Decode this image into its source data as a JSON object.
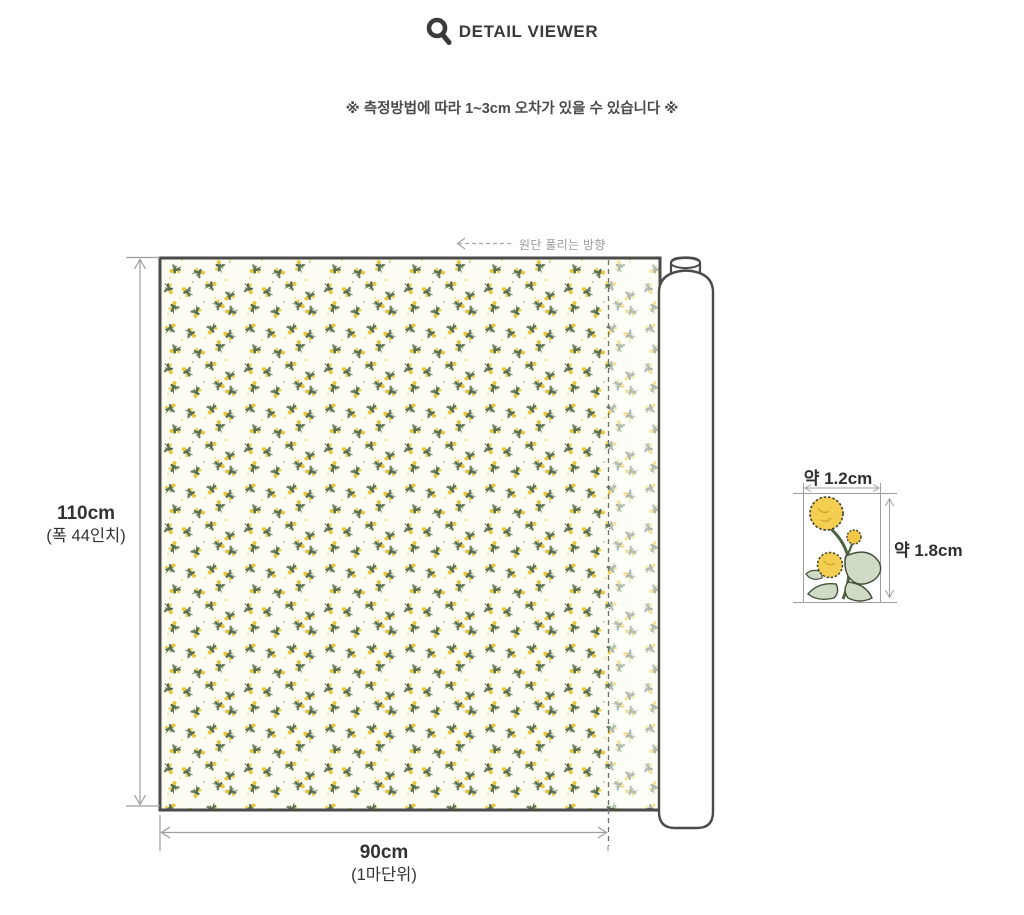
{
  "header": {
    "title": "DETAIL VIEWER"
  },
  "notice": "※ 측정방법에 따라 1~3cm 오차가 있을 수 있습니다 ※",
  "fabric_diagram": {
    "unroll_direction": "원단 풀리는 방향",
    "height": {
      "value": "110cm",
      "note": "(폭 44인치)"
    },
    "width": {
      "value": "90cm",
      "note": "(1마단위)"
    }
  },
  "motif_detail": {
    "width_label": "약 1.2cm",
    "height_label": "약 1.8cm"
  },
  "colors": {
    "title_text": "#3a3a3a",
    "notice_text": "#4a4a4a",
    "fabric_border": "#4b4b4b",
    "fabric_background": "#fdfcf2",
    "pattern_green": "#5d7354",
    "pattern_yellow": "#eac33a",
    "dimension_line": "#9e9e9e",
    "dimension_text": "#333333"
  }
}
